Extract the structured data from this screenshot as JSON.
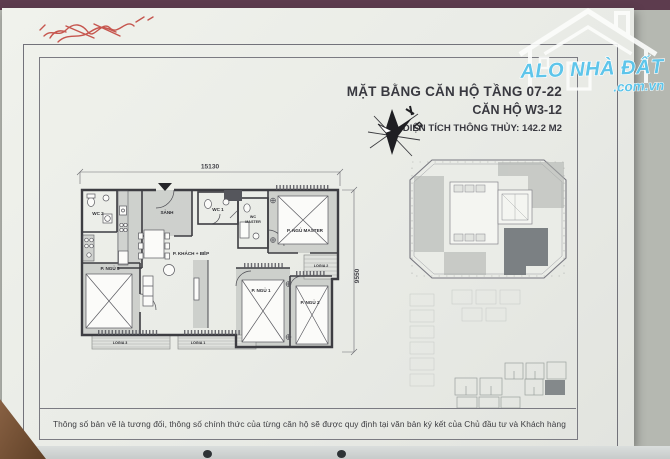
{
  "document": {
    "title_block": {
      "line1": "MẶT BẰNG CĂN HỘ TẦNG 07-22",
      "line2": "CĂN HỘ W3-12",
      "line3": "DIỆN TÍCH THÔNG THỦY: 142.2 M2"
    },
    "compass": {
      "north_label": "B"
    },
    "plan": {
      "dimensions": {
        "top": "15130",
        "right": "9550"
      },
      "rooms": {
        "hall": "SẢNH",
        "wc1": "WC 1",
        "wc2": "WC 2",
        "wc_master_line1": "WC",
        "wc_master_line2": "MASTER",
        "living": "P. KHÁCH + BẾP",
        "master": "P. NGỦ MASTER",
        "bed1": "P. NGỦ 1",
        "bed2": "P. NGỦ 2",
        "bed3": "P. NGỦ 3",
        "logia1": "LOGIA 1",
        "logia2": "LOGIA 2",
        "logia3": "LOGIA 3"
      }
    },
    "footer_note": "Thông số bản vẽ là tương đối, thông số chính thức của từng căn hộ sẽ được quy định tại văn bản ký kết của Chủ đầu tư và Khách hàng"
  },
  "watermark": {
    "brand": "ALO NHÀ ĐẤT",
    "domain": ".com.vn",
    "accent_color": "#5ec5ea"
  }
}
